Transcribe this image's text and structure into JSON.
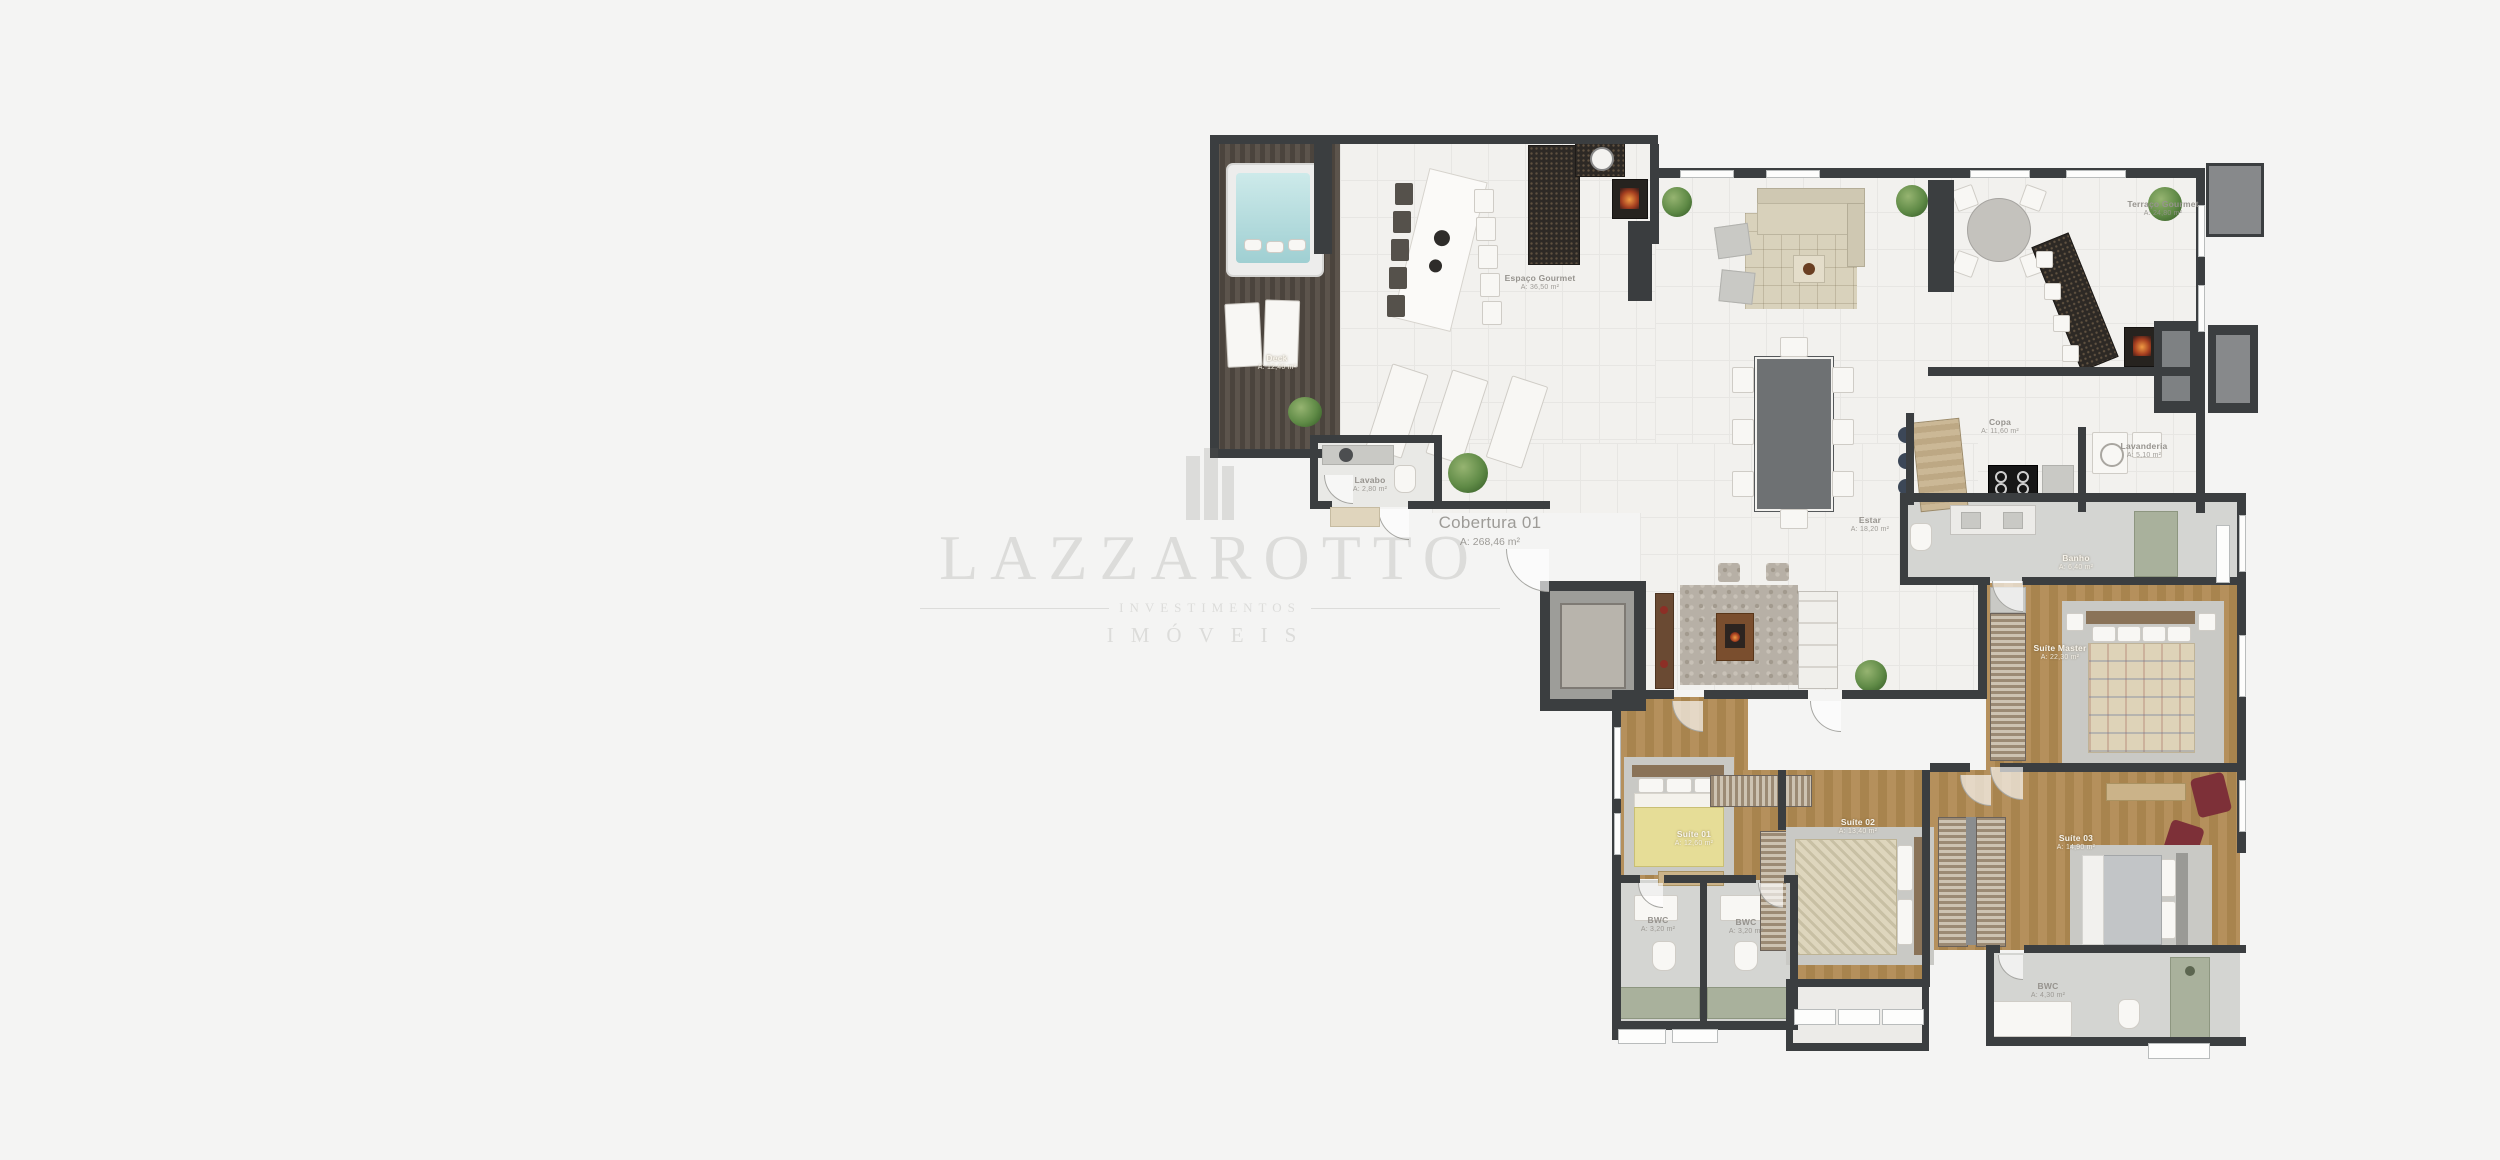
{
  "watermark": {
    "brand": "LAZZAROTTO",
    "line2": "INVESTIMENTOS",
    "line3": "IMÓVEIS"
  },
  "unit": {
    "name": "Cobertura 01",
    "area": "A: 268,46 m²"
  },
  "rooms": {
    "deck": {
      "name": "Deck",
      "area": "A: 12,40 m²"
    },
    "espaco_gourmet": {
      "name": "Espaço Gourmet",
      "area": "A: 36,50 m²"
    },
    "terraco_gourmet": {
      "name": "Terraço Gourmet",
      "area": "A: 24,80 m²"
    },
    "lavabo": {
      "name": "Lavabo",
      "area": "A: 2,80 m²"
    },
    "estar": {
      "name": "Estar",
      "area": "A: 18,20 m²"
    },
    "copa": {
      "name": "Copa",
      "area": "A: 11,60 m²"
    },
    "lavanderia": {
      "name": "Lavanderia",
      "area": "A: 5,10 m²"
    },
    "banho_master": {
      "name": "Banho",
      "area": "A: 6,40 m²"
    },
    "suite_master": {
      "name": "Suíte Master",
      "area": "A: 22,30 m²"
    },
    "suite_01": {
      "name": "Suíte 01",
      "area": "A: 12,60 m²"
    },
    "suite_02": {
      "name": "Suíte 02",
      "area": "A: 13,40 m²"
    },
    "suite_03": {
      "name": "Suíte 03",
      "area": "A: 14,90 m²"
    },
    "bwc_01": {
      "name": "BWC",
      "area": "A: 3,20 m²"
    },
    "bwc_02": {
      "name": "BWC",
      "area": "A: 3,20 m²"
    },
    "bwc_suite": {
      "name": "BWC",
      "area": "A: 4,30 m²"
    }
  },
  "colors": {
    "wall": "#3b3e40",
    "deck_wood": "#554d46",
    "bedroom_wood": "#b08e5e",
    "spa_water": "#bfe0e0",
    "accent_chair": "#7d3038",
    "plant": "#5f8f4f"
  }
}
